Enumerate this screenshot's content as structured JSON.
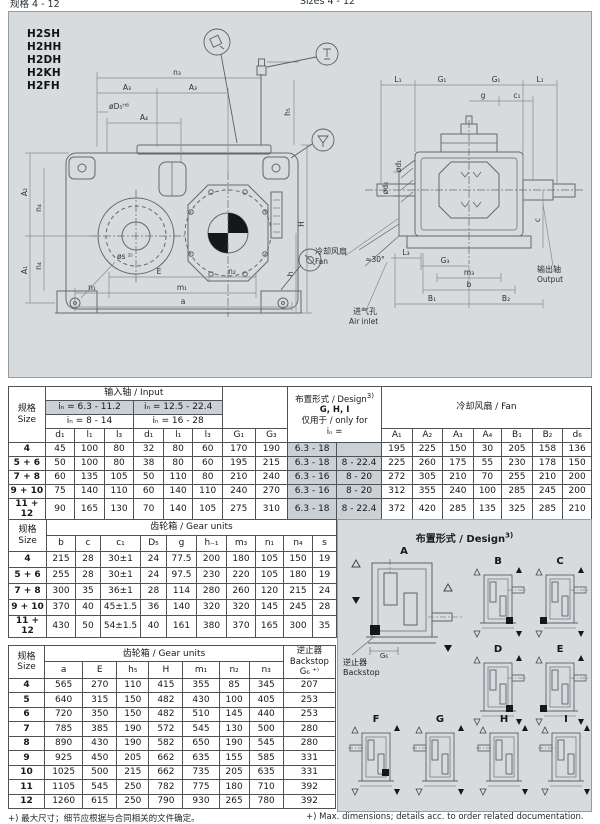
{
  "page": {
    "header_left": "规格 4 - 12",
    "header_right": "Sizes 4 - 12",
    "footnote_zh": "+) 最大尺寸；细节应根据与合同相关的文件确定。",
    "footnote_en": "+) Max. dimensions; details acc. to order related documentation."
  },
  "models": [
    "H2SH",
    "H2HH",
    "H2DH",
    "H2KH",
    "H2FH"
  ],
  "drawing": {
    "front": {
      "n3": "n₃",
      "a3_left": "A₃",
      "a3_right": "A₃",
      "d5": "øD₅ᴴ⁸",
      "a4": "A₄",
      "h5": "h₅",
      "H": "H",
      "h": "h",
      "a2": "A₂",
      "n4_top": "n₄",
      "a1": "A₁",
      "n4_bottom": "n₄",
      "s": "øs ²⁾",
      "e": "E",
      "n2": "n₂",
      "n1": "n₁",
      "m1": "m₁",
      "a": "a"
    },
    "side": {
      "l1_left": "L₁",
      "g1_left": "G₁",
      "g1_right": "G₁",
      "l1_right": "L₁",
      "g": "g",
      "c1": "c₁",
      "d1": "ød₁",
      "d6": "ød₆",
      "c": "c",
      "l3": "L₃",
      "g3": "G₃",
      "m3": "m₃",
      "b": "b",
      "b1": "B₁",
      "b2": "B₂",
      "angle": "≈30°"
    },
    "callouts": {
      "fan_zh": "冷却风扇",
      "fan_en": "Fan",
      "air_zh": "进气孔",
      "air_en": "Air inlet",
      "out_zh": "输出轴",
      "out_en": "Output"
    }
  },
  "table_input": {
    "size_zh": "规格",
    "size_en": "Size",
    "group": "输入轴 / Input",
    "ratio_a1": "iₙ = 6.3 - 11.2",
    "ratio_a2": "iₙ = 8 - 14",
    "ratio_b1": "iₙ = 12.5 - 22.4",
    "ratio_b2": "iₙ = 16 - 28",
    "design_l1": "布置形式 / Design",
    "design_sup": "3)",
    "design_l2": "G, H, I",
    "design_l3": "仅用于 / only for",
    "design_l4": "iₙ =",
    "fan_group": "冷却风扇 / Fan",
    "col_letters": [
      "d₁",
      "l₁",
      "l₃",
      "d₁",
      "l₁",
      "l₃",
      "G₁",
      "G₃"
    ],
    "fan_letters": [
      "A₁",
      "A₂",
      "A₃",
      "A₄",
      "B₁",
      "B₂",
      "d₆"
    ],
    "rows": [
      {
        "size": "4",
        "cells": [
          "45",
          "100",
          "80",
          "32",
          "80",
          "60",
          "170",
          "190",
          "6.3 - 18",
          "",
          "195",
          "225",
          "150",
          "30",
          "205",
          "158",
          "136"
        ]
      },
      {
        "size": "5 + 6",
        "cells": [
          "50",
          "100",
          "80",
          "38",
          "80",
          "60",
          "195",
          "215",
          "6.3 - 18",
          "8 - 22.4",
          "225",
          "260",
          "175",
          "55",
          "230",
          "178",
          "150"
        ]
      },
      {
        "size": "7 + 8",
        "cells": [
          "60",
          "135",
          "105",
          "50",
          "110",
          "80",
          "210",
          "240",
          "6.3 - 16",
          "8 - 20",
          "272",
          "305",
          "210",
          "70",
          "255",
          "210",
          "200"
        ]
      },
      {
        "size": "9 + 10",
        "cells": [
          "75",
          "140",
          "110",
          "60",
          "140",
          "110",
          "240",
          "270",
          "6.3 - 16",
          "8 - 20",
          "312",
          "355",
          "240",
          "100",
          "285",
          "245",
          "200"
        ]
      },
      {
        "size": "11 + 12",
        "cells": [
          "90",
          "165",
          "130",
          "70",
          "140",
          "105",
          "275",
          "310",
          "6.3 - 18",
          "8 - 22.4",
          "372",
          "420",
          "285",
          "135",
          "325",
          "285",
          "210"
        ]
      }
    ]
  },
  "table_gear_a": {
    "size_zh": "规格",
    "size_en": "Size",
    "group": "齿轮箱 / Gear units",
    "col_letters": [
      "b",
      "c",
      "c₁",
      "D₅",
      "g",
      "h₋₁",
      "m₃",
      "n₁",
      "n₄",
      "s"
    ],
    "rows": [
      {
        "size": "4",
        "cells": [
          "215",
          "28",
          "30±1",
          "24",
          "77.5",
          "200",
          "180",
          "105",
          "150",
          "19"
        ]
      },
      {
        "size": "5 + 6",
        "cells": [
          "255",
          "28",
          "30±1",
          "24",
          "97.5",
          "230",
          "220",
          "105",
          "180",
          "19"
        ]
      },
      {
        "size": "7 + 8",
        "cells": [
          "300",
          "35",
          "36±1",
          "28",
          "114",
          "280",
          "260",
          "120",
          "215",
          "24"
        ]
      },
      {
        "size": "9 + 10",
        "cells": [
          "370",
          "40",
          "45±1.5",
          "36",
          "140",
          "320",
          "320",
          "145",
          "245",
          "28"
        ]
      },
      {
        "size": "11 + 12",
        "cells": [
          "430",
          "50",
          "54±1.5",
          "40",
          "161",
          "380",
          "370",
          "165",
          "300",
          "35"
        ]
      }
    ]
  },
  "table_gear_b": {
    "size_zh": "规格",
    "size_en": "Size",
    "group": "齿轮箱 / Gear units",
    "backstop_zh": "逆止器",
    "backstop_en": "Backstop",
    "backstop_dim": "G₆ ⁺⁾",
    "col_letters": [
      "a",
      "E",
      "h₅",
      "H",
      "m₁",
      "n₂",
      "n₃"
    ],
    "rows": [
      {
        "size": "4",
        "cells": [
          "565",
          "270",
          "110",
          "415",
          "355",
          "85",
          "345",
          "207"
        ]
      },
      {
        "size": "5",
        "cells": [
          "640",
          "315",
          "150",
          "482",
          "430",
          "100",
          "405",
          "253"
        ]
      },
      {
        "size": "6",
        "cells": [
          "720",
          "350",
          "150",
          "482",
          "510",
          "145",
          "440",
          "253"
        ]
      },
      {
        "size": "7",
        "cells": [
          "785",
          "385",
          "190",
          "572",
          "545",
          "130",
          "500",
          "280"
        ]
      },
      {
        "size": "8",
        "cells": [
          "890",
          "430",
          "190",
          "582",
          "650",
          "190",
          "545",
          "280"
        ]
      },
      {
        "size": "9",
        "cells": [
          "925",
          "450",
          "205",
          "662",
          "635",
          "155",
          "585",
          "331"
        ]
      },
      {
        "size": "10",
        "cells": [
          "1025",
          "500",
          "215",
          "662",
          "735",
          "205",
          "635",
          "331"
        ]
      },
      {
        "size": "11",
        "cells": [
          "1105",
          "545",
          "250",
          "782",
          "775",
          "180",
          "710",
          "392"
        ]
      },
      {
        "size": "12",
        "cells": [
          "1260",
          "615",
          "250",
          "790",
          "930",
          "265",
          "780",
          "392"
        ]
      }
    ]
  },
  "design_panel": {
    "title": "布置形式 / Design",
    "title_sup": "3)",
    "letters": [
      "A",
      "B",
      "C",
      "D",
      "E",
      "F",
      "G",
      "H",
      "I"
    ],
    "backstop_zh": "逆止器",
    "backstop_en": "Backstop",
    "dim": "G₆"
  }
}
